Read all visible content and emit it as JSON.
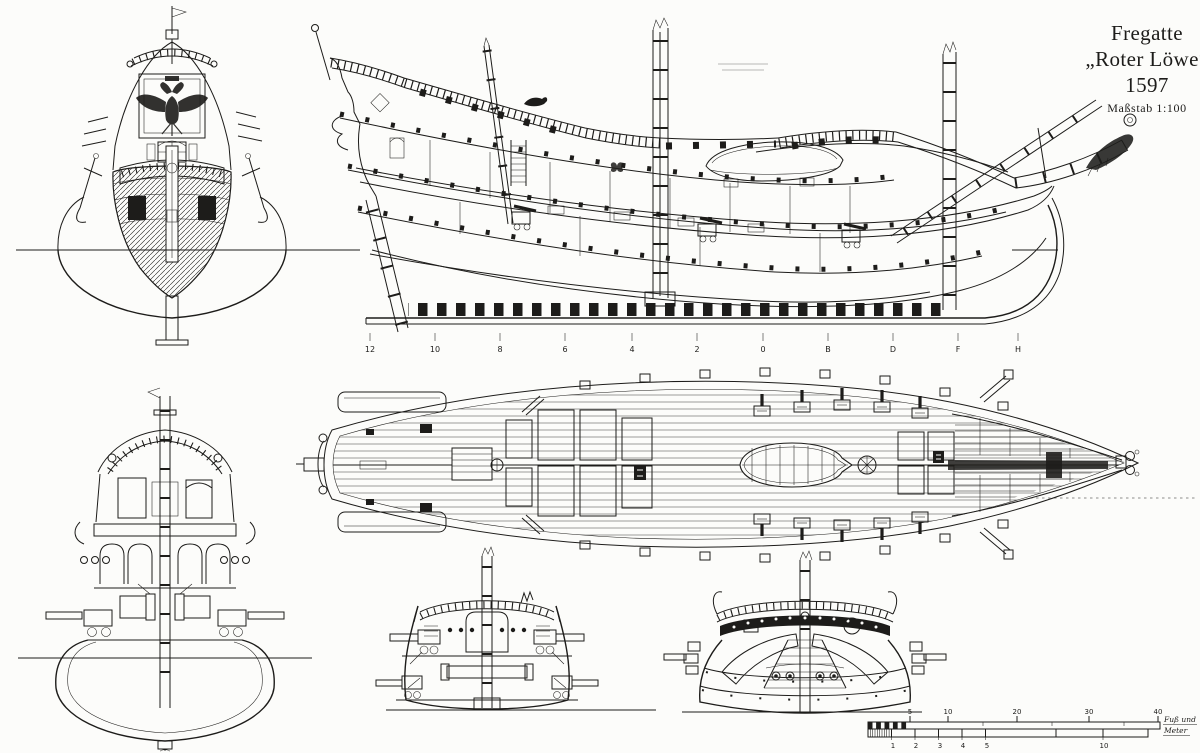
{
  "colors": {
    "ink": "#1d1c1a",
    "paper": "#fcfcfa"
  },
  "title_block": {
    "line1": "Fregatte",
    "line2": "„Roter Löwe“",
    "line3": "1597",
    "scale_note": "Maßstab 1:100"
  },
  "stations": {
    "labels": [
      "12",
      "10",
      "8",
      "6",
      "4",
      "2",
      "0",
      "B",
      "D",
      "F",
      "H"
    ]
  },
  "scale_bar": {
    "feet_labels": [
      "5",
      "10",
      "20",
      "30",
      "40"
    ],
    "meter_labels": [
      "1",
      "2",
      "3",
      "4",
      "5",
      "10"
    ],
    "unit_line1": "Fuß und",
    "unit_line2": "Meter"
  }
}
